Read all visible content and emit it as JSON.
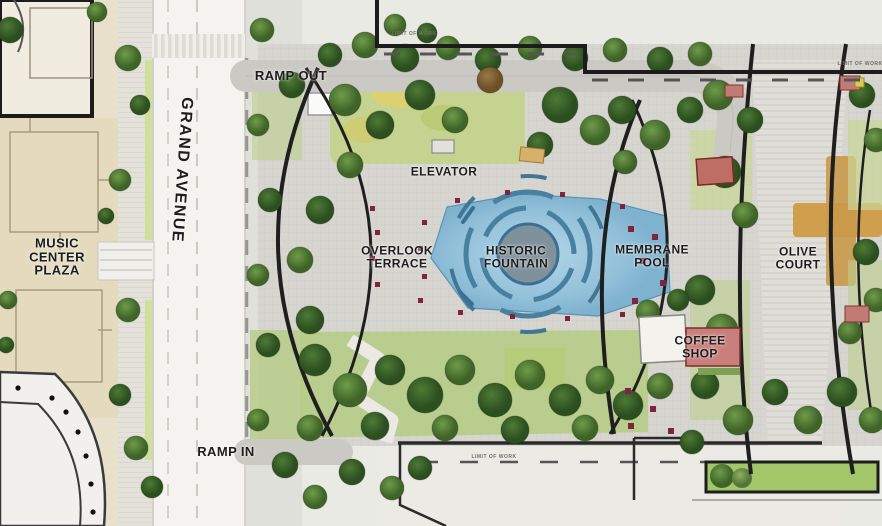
{
  "map": {
    "title": "Civic park site plan",
    "streets": {
      "grand_avenue": "GRAND AVENUE"
    },
    "ramps": {
      "ramp_out": "RAMP OUT",
      "ramp_in": "RAMP IN"
    },
    "places": {
      "music_center_plaza": "MUSIC CENTER PLAZA",
      "elevator": "ELEVATOR",
      "overlook_terrace": "OVERLOOK TERRACE",
      "historic_fountain": "HISTORIC FOUNTAIN",
      "membrane_pool": "MEMBRANE POOL",
      "olive_court": "OLIVE COURT",
      "coffee_shop": "COFFEE SHOP"
    },
    "annotations": {
      "limit_of_work": "LIMIT OF WORK"
    },
    "colors": {
      "water_blue": "#9cc6de",
      "water_ring_blue": "#49809f",
      "tree_green_dark": "#2c4f1f",
      "tree_green_mid": "#3f6428",
      "tree_green_light": "#55763a",
      "lawn_green": "#b9cd8a",
      "paving_gray": "#d7d5d0",
      "street_white": "#f4f3ef",
      "plaza_beige": "#e8e0ca",
      "accent_red": "#7e2340",
      "roof_red": "#bf6e66",
      "path_tan": "#cf9f4e",
      "line_black": "#1c1c1c"
    }
  }
}
